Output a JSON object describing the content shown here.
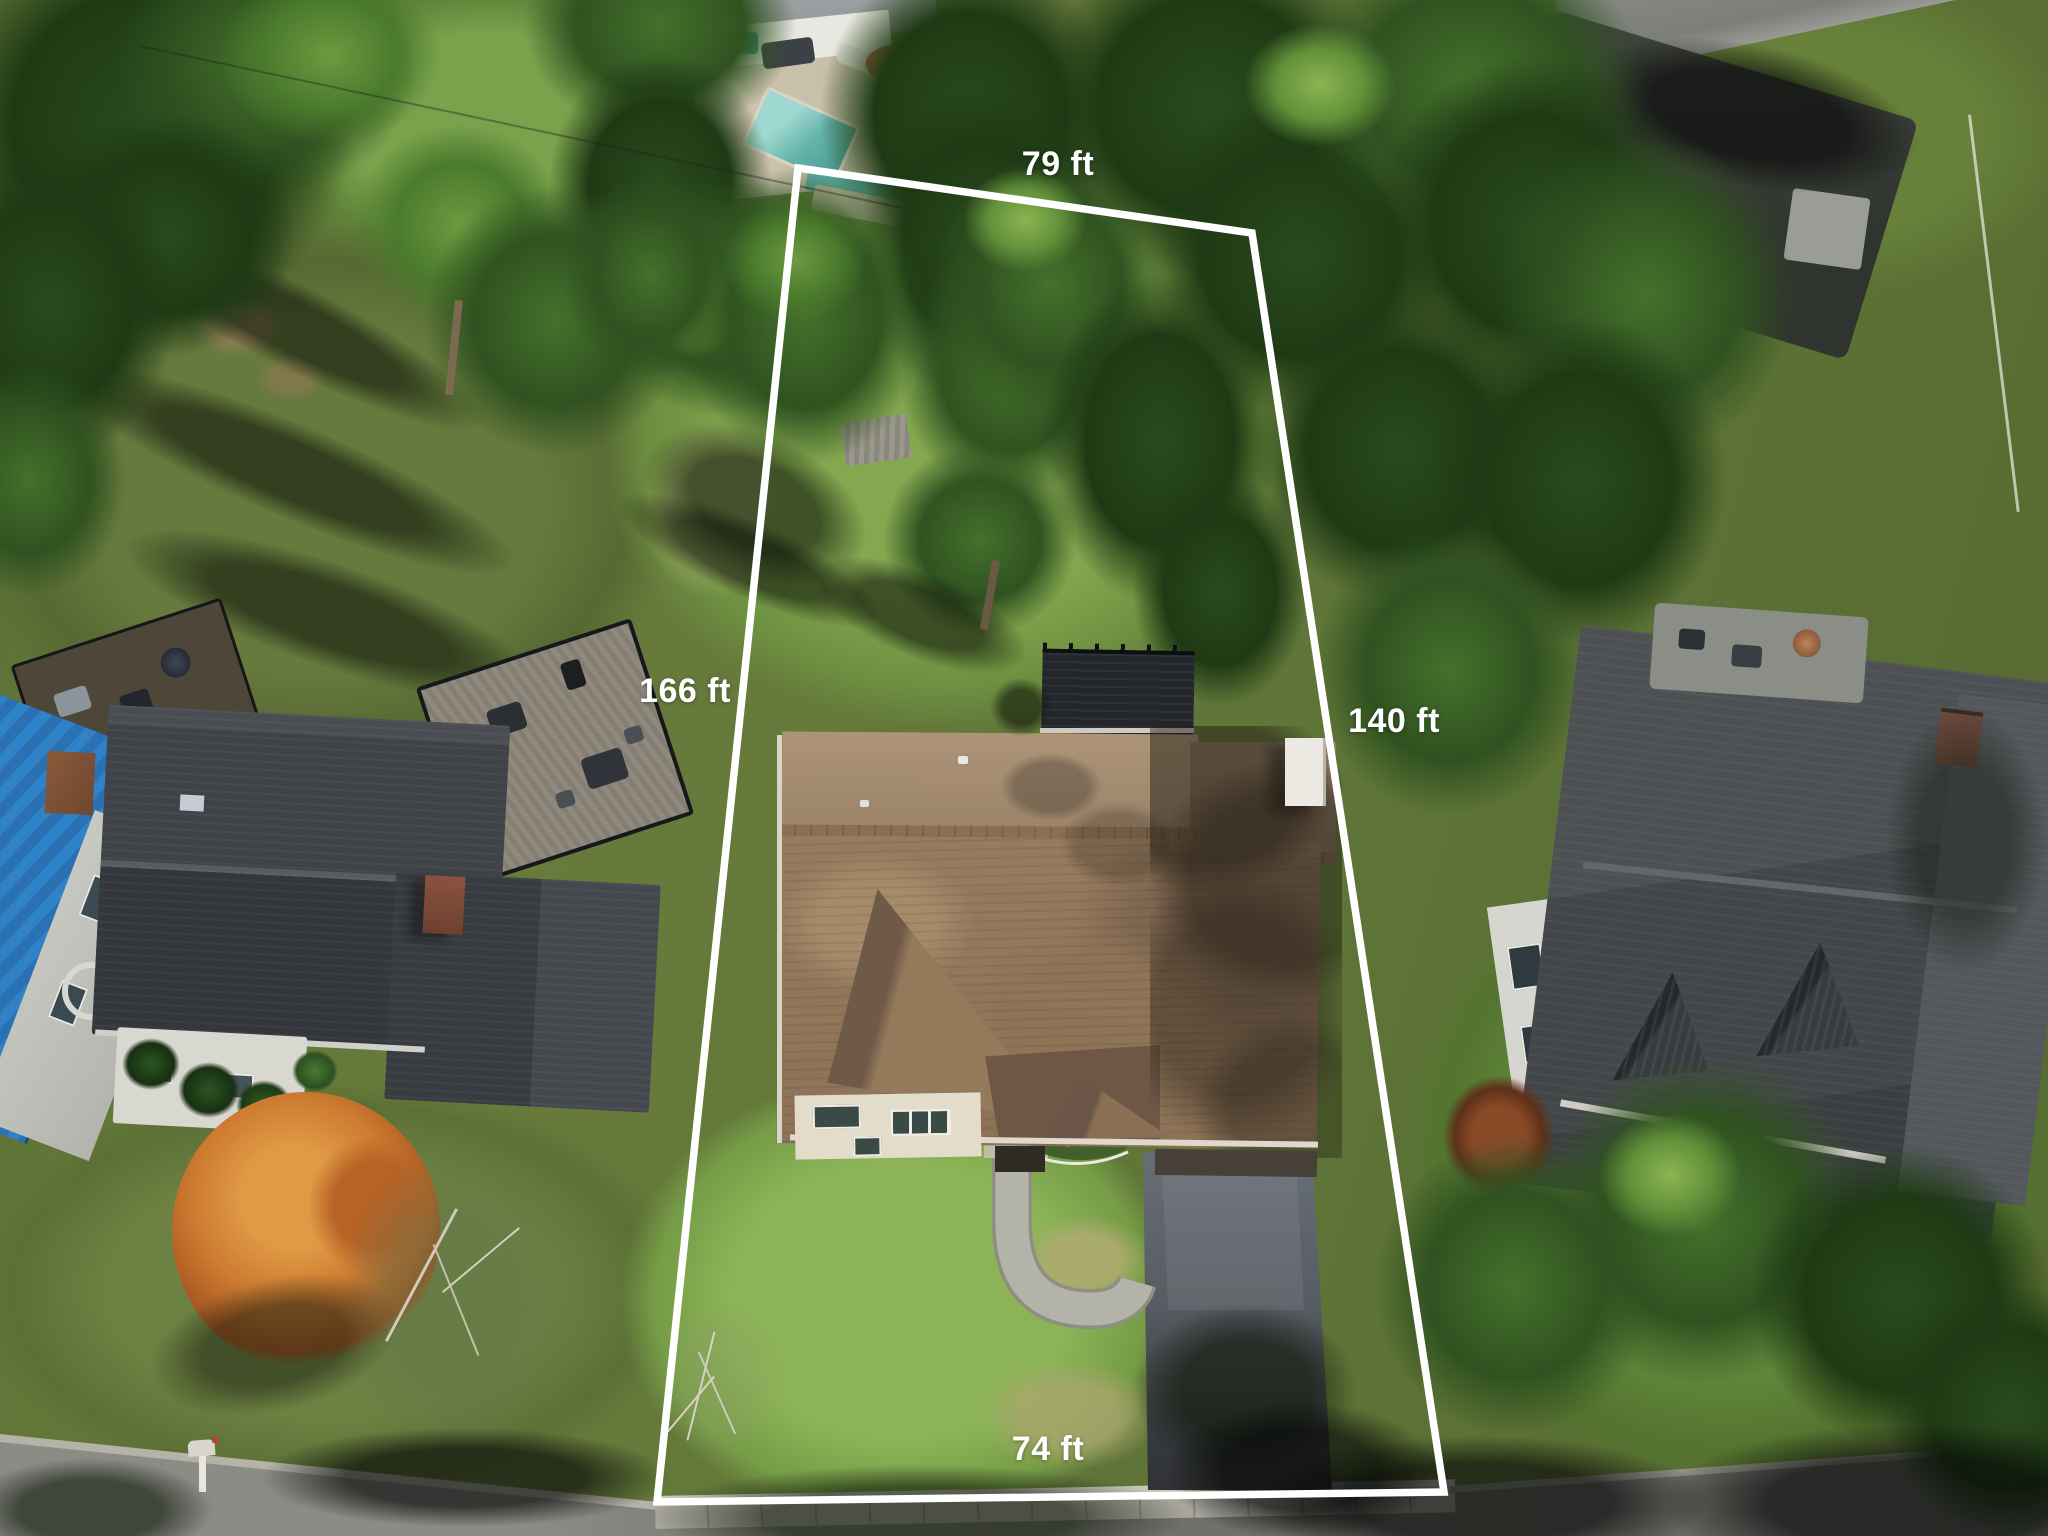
{
  "meta": {
    "type": "aerial-property-photo",
    "description": "Drone aerial view of a suburban lot with a white property-boundary overlay and four lot dimension labels"
  },
  "annotation": {
    "boundary_color": "#ffffff",
    "label_color": "#ffffff",
    "labels": [
      {
        "side": "top",
        "text": "79 ft"
      },
      {
        "side": "left",
        "text": "166 ft"
      },
      {
        "side": "right",
        "text": "140 ft"
      },
      {
        "side": "bottom",
        "text": "74 ft"
      }
    ]
  },
  "scene": {
    "subject_house_roof_color": "#967b5e",
    "left_house_roof_color": "#3f4247",
    "left_house_metal_roof_color": "#2f82c8",
    "right_house_roof_color": "#474a4e",
    "pool_color": "#64b4ac",
    "autumn_tree_color": "#cc7a30",
    "driveway_color": "#3f4349",
    "road_color": "#6e6f6a",
    "boundary_shape": "quadrilateral"
  }
}
